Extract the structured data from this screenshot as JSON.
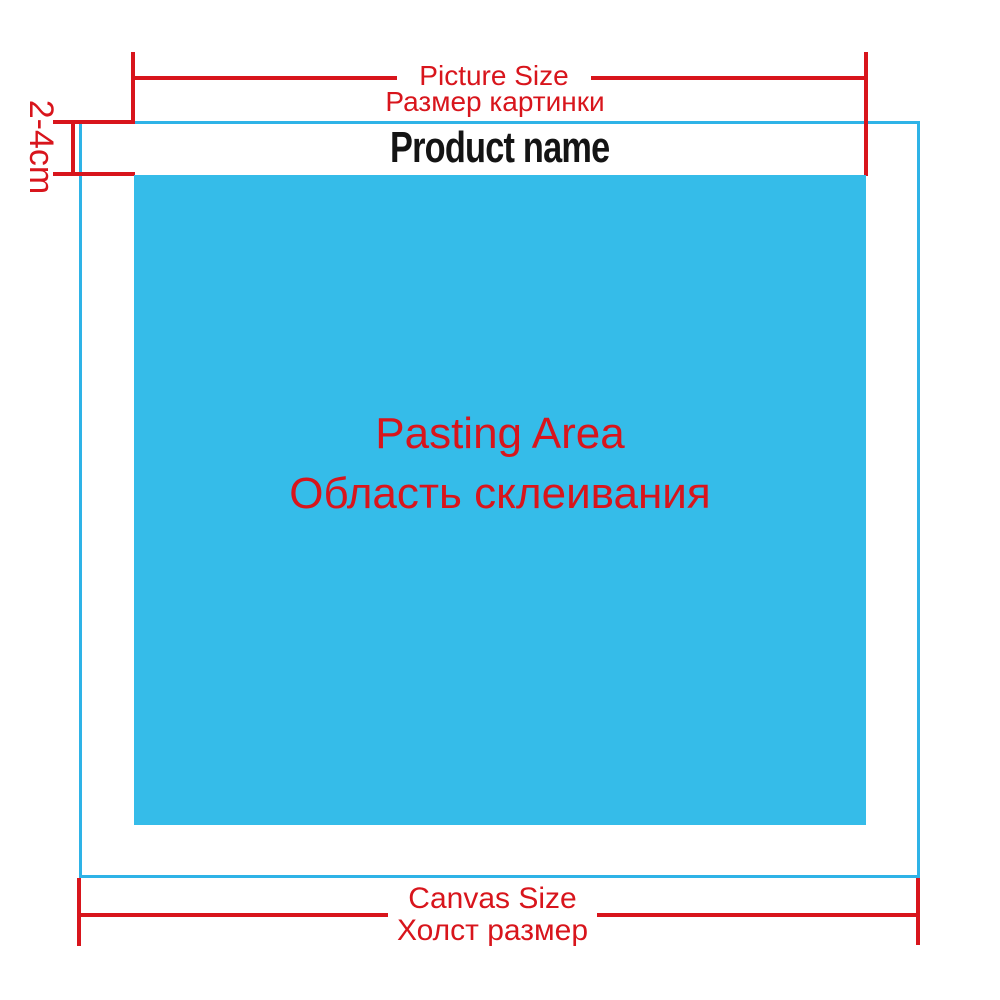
{
  "colors": {
    "dimension_red": "#d8151c",
    "canvas_border_cyan": "#2eb3e7",
    "pasting_area_blue": "#35bce9",
    "product_name_black": "#141414",
    "background_white": "#ffffff"
  },
  "product": {
    "name": "Product name"
  },
  "top_dimension": {
    "label_en": "Picture Size",
    "label_ru": "Размер картинки"
  },
  "left_dimension": {
    "label": "2-4cm"
  },
  "pasting_area": {
    "label_en": "Pasting Area",
    "label_ru": "Область склеивания"
  },
  "bottom_dimension": {
    "label_en": "Canvas Size",
    "label_ru": "Холст размер"
  }
}
